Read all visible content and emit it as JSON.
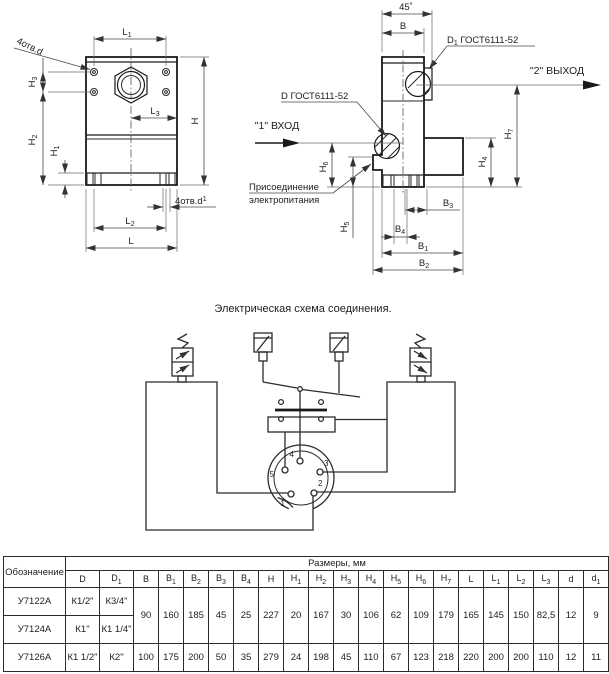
{
  "drawing": {
    "labels": {
      "L": {
        "b": "L",
        "s": ""
      },
      "L1": {
        "b": "L",
        "s": "1"
      },
      "L2": {
        "b": "L",
        "s": "2"
      },
      "L3": {
        "b": "L",
        "s": "3"
      },
      "H": {
        "b": "H",
        "s": ""
      },
      "H1": {
        "b": "H",
        "s": "1"
      },
      "H2": {
        "b": "H",
        "s": "2"
      },
      "H3": {
        "b": "H",
        "s": "3"
      },
      "H4": {
        "b": "H",
        "s": "4"
      },
      "H5": {
        "b": "H",
        "s": "5"
      },
      "H6": {
        "b": "H",
        "s": "6"
      },
      "H7": {
        "b": "H",
        "s": "7"
      },
      "B": {
        "b": "B",
        "s": ""
      },
      "B1": {
        "b": "B",
        "s": "1"
      },
      "B2": {
        "b": "B",
        "s": "2"
      },
      "B3": {
        "b": "B",
        "s": "3"
      },
      "B4": {
        "b": "B",
        "s": "4"
      },
      "holes_d": "4отв.d",
      "holes_d1": {
        "b": "4отв.d",
        "s": "1"
      },
      "angle": "45˚",
      "gost_d": "D ГОСТ6111-52",
      "gost_d1": {
        "b": "D",
        "s": "1",
        "rest": " ГОСТ6111-52"
      },
      "inlet": "\"1\" ВХОД",
      "outlet": "\"2\" ВЫХОД",
      "power1": "Присоединение",
      "power2": "электропитания"
    }
  },
  "schematic": {
    "title": "Электрическая схема соединения.",
    "pins": [
      "1",
      "2",
      "3",
      "4",
      "5"
    ]
  },
  "table": {
    "designation_header": "Обозначение",
    "group_header": "Размеры, мм",
    "columns": [
      {
        "b": "D",
        "s": ""
      },
      {
        "b": "D",
        "s": "1"
      },
      {
        "b": "B",
        "s": ""
      },
      {
        "b": "B",
        "s": "1"
      },
      {
        "b": "B",
        "s": "2"
      },
      {
        "b": "B",
        "s": "3"
      },
      {
        "b": "B",
        "s": "4"
      },
      {
        "b": "H",
        "s": ""
      },
      {
        "b": "H",
        "s": "1"
      },
      {
        "b": "H",
        "s": "2"
      },
      {
        "b": "H",
        "s": "3"
      },
      {
        "b": "H",
        "s": "4"
      },
      {
        "b": "H",
        "s": "5"
      },
      {
        "b": "H",
        "s": "6"
      },
      {
        "b": "H",
        "s": "7"
      },
      {
        "b": "L",
        "s": ""
      },
      {
        "b": "L",
        "s": "1"
      },
      {
        "b": "L",
        "s": "2"
      },
      {
        "b": "L",
        "s": "3"
      },
      {
        "b": "d",
        "s": ""
      },
      {
        "b": "d",
        "s": "1"
      }
    ],
    "rows": [
      {
        "name": "У7122А",
        "D": "К1/2\"",
        "D1": "К3/4\""
      },
      {
        "name": "У7124А",
        "D": "К1\"",
        "D1": "К1 1/4\""
      },
      {
        "name": "У7126А",
        "D": "К1 1/2\"",
        "D1": "К2\"",
        "values": [
          "100",
          "175",
          "200",
          "50",
          "35",
          "279",
          "24",
          "198",
          "45",
          "110",
          "67",
          "123",
          "218",
          "220",
          "200",
          "200",
          "110",
          "12",
          "11"
        ]
      }
    ],
    "shared_values": [
      "90",
      "160",
      "185",
      "45",
      "25",
      "227",
      "20",
      "167",
      "30",
      "106",
      "62",
      "109",
      "179",
      "165",
      "145",
      "150",
      "82,5",
      "12",
      "9"
    ]
  }
}
